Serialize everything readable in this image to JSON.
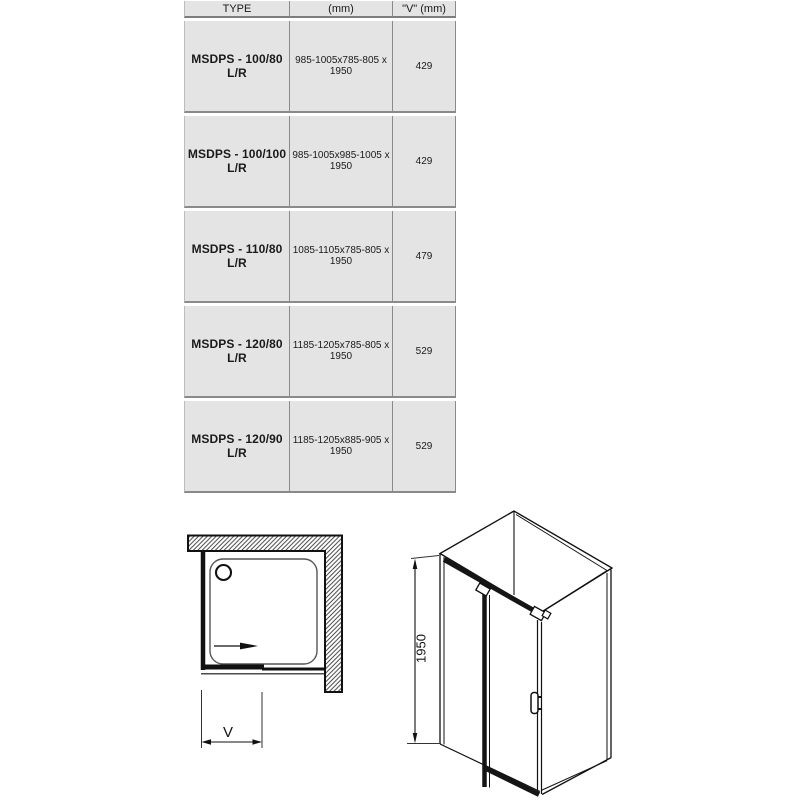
{
  "table": {
    "headers": [
      "TYPE",
      "(mm)",
      "\"V\" (mm)"
    ],
    "rows": [
      {
        "type": "MSDPS - 100/80 L/R",
        "mm": "985-1005x785-805 x 1950",
        "v": "429"
      },
      {
        "type": "MSDPS - 100/100 L/R",
        "mm": "985-1005x985-1005 x 1950",
        "v": "429"
      },
      {
        "type": "MSDPS - 110/80 L/R",
        "mm": "1085-1105x785-805 x 1950",
        "v": "479"
      },
      {
        "type": "MSDPS - 120/80 L/R",
        "mm": "1185-1205x785-805 x 1950",
        "v": "529"
      },
      {
        "type": "MSDPS - 120/90 L/R",
        "mm": "1185-1205x885-905 x 1950",
        "v": "529"
      }
    ]
  },
  "diagrams": {
    "plan_view": {
      "dimension_label": "V"
    },
    "perspective_view": {
      "height_label": "1950"
    }
  },
  "colors": {
    "cell_bg": "#e4e4e4",
    "grid_line": "#8a8a8a",
    "drawing_line": "#111111"
  }
}
